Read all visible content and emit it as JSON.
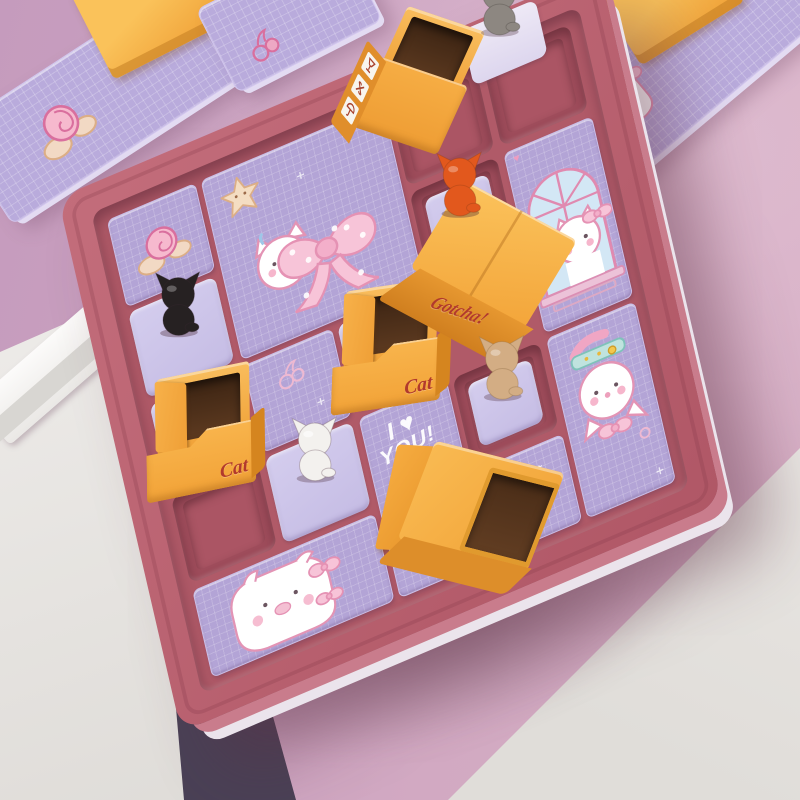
{
  "labels": {
    "cat_box": "Cat",
    "gotcha_box": "Gotcha!",
    "love_lines": [
      "I ♥",
      "YOU!"
    ],
    "sweet": "sweet"
  },
  "deco": {
    "sparkle": "+",
    "heart": "♥"
  },
  "board": {
    "rows": 5,
    "cols": 5
  },
  "box_icons": [
    "fragile-glass",
    "pinwheel",
    "umbrella-hook"
  ],
  "cats": {
    "black": {
      "name": "black-cat",
      "color": "#262122"
    },
    "orange": {
      "name": "orange-cat",
      "color": "#e2581d"
    },
    "gray": {
      "name": "gray-cat",
      "color": "#8d8781"
    },
    "white": {
      "name": "white-cat",
      "color": "#f3f1ee"
    },
    "tan": {
      "name": "tan-cat",
      "color": "#d3ad84"
    }
  },
  "colors": {
    "wall_left": "#c59bbd",
    "wall_right": "#d5adc3",
    "table": "#e8e6e3",
    "frame_white": "#f7f6f4",
    "frame_shadow": "#5e4c63",
    "board_rail": "#b95f6e",
    "board_field": "#b05a68",
    "recess": "#9e4c5b",
    "slot": "#ccc4e9",
    "tile": "#b3a4d6",
    "tile_edge": "#ccbfe9",
    "box_orange": "#f5ab3f",
    "box_orange_dark": "#dd8e2c",
    "box_interior": "#53331e",
    "label_red": "#b23a2c",
    "doodle_pink": "#e08ab0",
    "window_blue": "#d3e7f5",
    "bow_pink": "#f7c4d8",
    "collar_teal": "#bfe3de"
  }
}
